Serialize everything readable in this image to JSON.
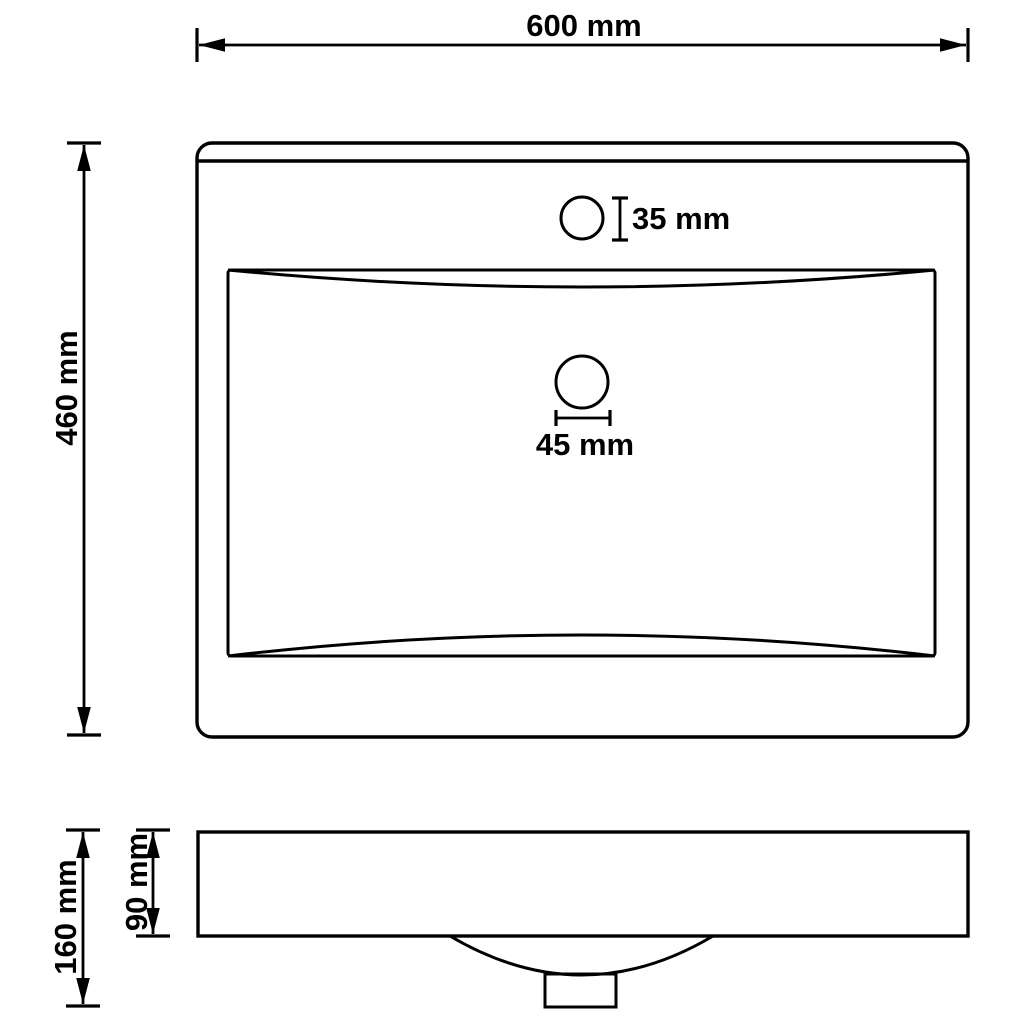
{
  "page": {
    "background_color": "#ffffff",
    "line_color": "#000000"
  },
  "diagram": {
    "type": "technical-drawing",
    "subject": "rectangular wash basin with faucet hole and drain, plan view and side elevation",
    "views": [
      {
        "id": "plan-view",
        "description": "top view of basin with faucet hole and drain hole"
      },
      {
        "id": "side-view",
        "description": "front elevation with bowl underside and drain stub"
      }
    ],
    "dimensions": {
      "overall_width": {
        "value": 600,
        "unit": "mm",
        "label": "600 mm"
      },
      "overall_depth": {
        "value": 460,
        "unit": "mm",
        "label": "460 mm"
      },
      "faucet_hole_diameter": {
        "value": 35,
        "unit": "mm",
        "label": "35 mm"
      },
      "drain_hole_diameter": {
        "value": 45,
        "unit": "mm",
        "label": "45 mm"
      },
      "overall_height": {
        "value": 160,
        "unit": "mm",
        "label": "160 mm"
      },
      "rim_height": {
        "value": 90,
        "unit": "mm",
        "label": "90 mm"
      }
    }
  }
}
